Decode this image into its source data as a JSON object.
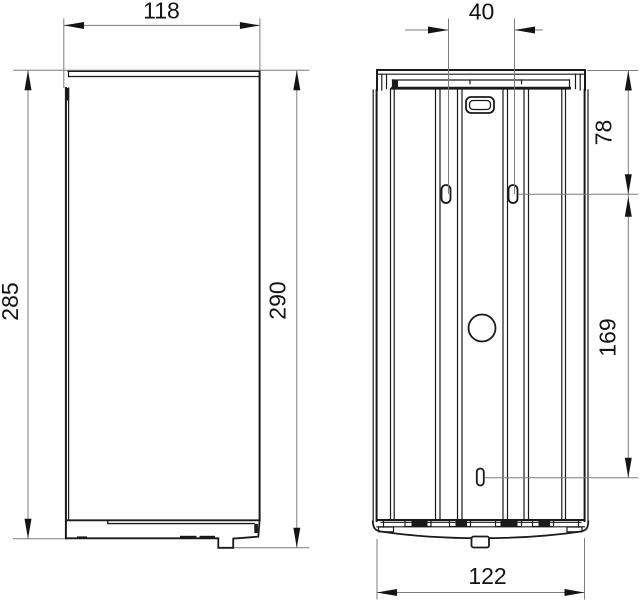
{
  "drawing": {
    "type": "technical-dimension-drawing",
    "background_color": "#ffffff",
    "object_line_color": "#1a1a1a",
    "dimension_line_color": "#7d7d7d",
    "text_color": "#141414",
    "views": [
      {
        "name": "side-view",
        "description": "side elevation of wall-mounted dispenser with lid, door and base with foot tab",
        "dimensions": [
          {
            "id": "depth-top",
            "value": "118",
            "orientation": "horizontal"
          },
          {
            "id": "body-height",
            "value": "285",
            "orientation": "vertical"
          },
          {
            "id": "overall-height",
            "value": "290",
            "orientation": "vertical"
          }
        ]
      },
      {
        "name": "rear-view",
        "description": "rear elevation with mounting plate, two keyhole slots, centre hole and lower fixing hole",
        "dimensions": [
          {
            "id": "keyhole-spacing",
            "value": "40",
            "orientation": "horizontal"
          },
          {
            "id": "top-to-keyholes",
            "value": "78",
            "orientation": "vertical"
          },
          {
            "id": "keyholes-to-lower-hole",
            "value": "169",
            "orientation": "vertical"
          },
          {
            "id": "width-bottom",
            "value": "122",
            "orientation": "horizontal"
          }
        ]
      }
    ]
  },
  "dims": {
    "d118": "118",
    "d285": "285",
    "d290": "290",
    "d40": "40",
    "d78": "78",
    "d169": "169",
    "d122": "122"
  }
}
